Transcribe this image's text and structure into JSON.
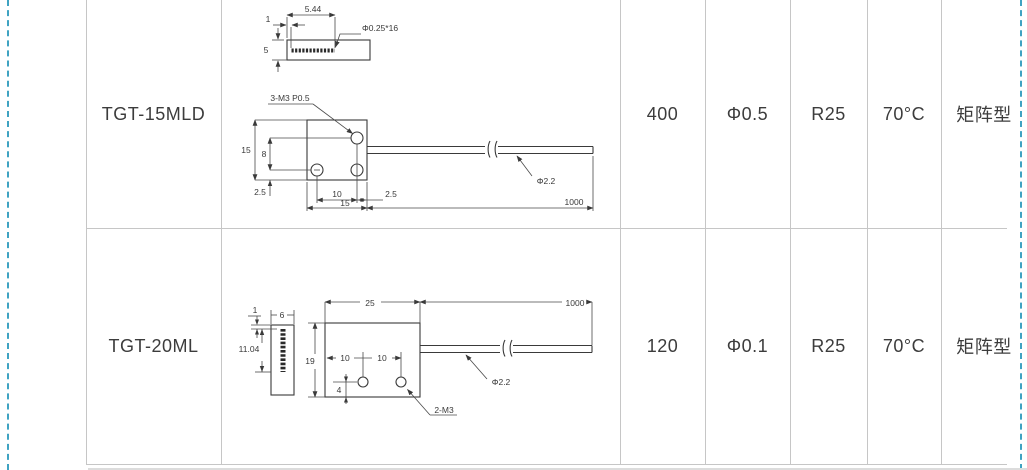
{
  "page": {
    "background": "#ffffff",
    "grid_color": "#c6c6c6",
    "drawing_line_color": "#3a3a3a",
    "margin_dash_color": "#3fa3c2",
    "text_color": "#3c3c3c"
  },
  "table": {
    "rows": [
      {
        "model": "TGT-15MLD",
        "specs": [
          "400",
          "Φ0.5",
          "R25",
          "70°C",
          "矩阵型"
        ]
      },
      {
        "model": "TGT-20ML",
        "specs": [
          "120",
          "Φ0.1",
          "R25",
          "70°C",
          "矩阵型"
        ]
      }
    ]
  },
  "drawings": {
    "tgt15mld": {
      "side_view": {
        "width_label": "5.44",
        "offset_label": "1",
        "height_label": "5",
        "fiber_label": "Φ0.25*16"
      },
      "front_view": {
        "thread_label": "3-M3 P0.5",
        "height_label": "15",
        "hole_row_label": "8",
        "bottom_offset_label": "2.5",
        "hole_pitch_label": "10",
        "edge_offset_label": "2.5",
        "width_label": "15",
        "cable_length_label": "1000",
        "cable_dia_label": "Φ2.2"
      }
    },
    "tgt20ml": {
      "front_view": {
        "offset_label": "1",
        "width_label": "6",
        "fiber_height_label": "11.04"
      },
      "side_view": {
        "width_label": "25",
        "cable_length_label": "1000",
        "height_label": "19",
        "pitch_label_1": "10",
        "pitch_label_2": "10",
        "hole_bottom_label": "4",
        "thread_label": "2-M3",
        "cable_dia_label": "Φ2.2"
      }
    }
  }
}
